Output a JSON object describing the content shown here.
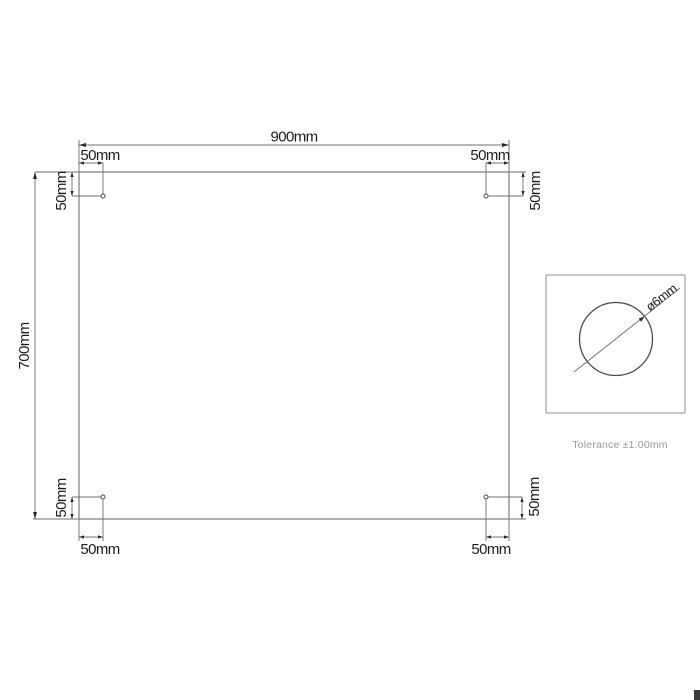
{
  "drawing": {
    "panel": {
      "width_label": "900mm",
      "height_label": "700mm"
    },
    "offsets": {
      "top_left_h": "50mm",
      "top_left_v": "50mm",
      "top_right_h": "50mm",
      "top_right_v": "50mm",
      "bottom_left_h": "50mm",
      "bottom_left_v": "50mm",
      "bottom_right_h": "50mm",
      "bottom_right_v": "50mm"
    },
    "detail": {
      "diameter_label": "ø6mm"
    },
    "tolerance_note": "Tolerance ±1.00mm"
  },
  "colors": {
    "line": "#707070",
    "dim-text": "#1c1c1c",
    "muted-text": "#9a9a9a",
    "detail-line": "#8f8f8f",
    "artifact": "#3d3d3d",
    "background": "#ffffff"
  }
}
